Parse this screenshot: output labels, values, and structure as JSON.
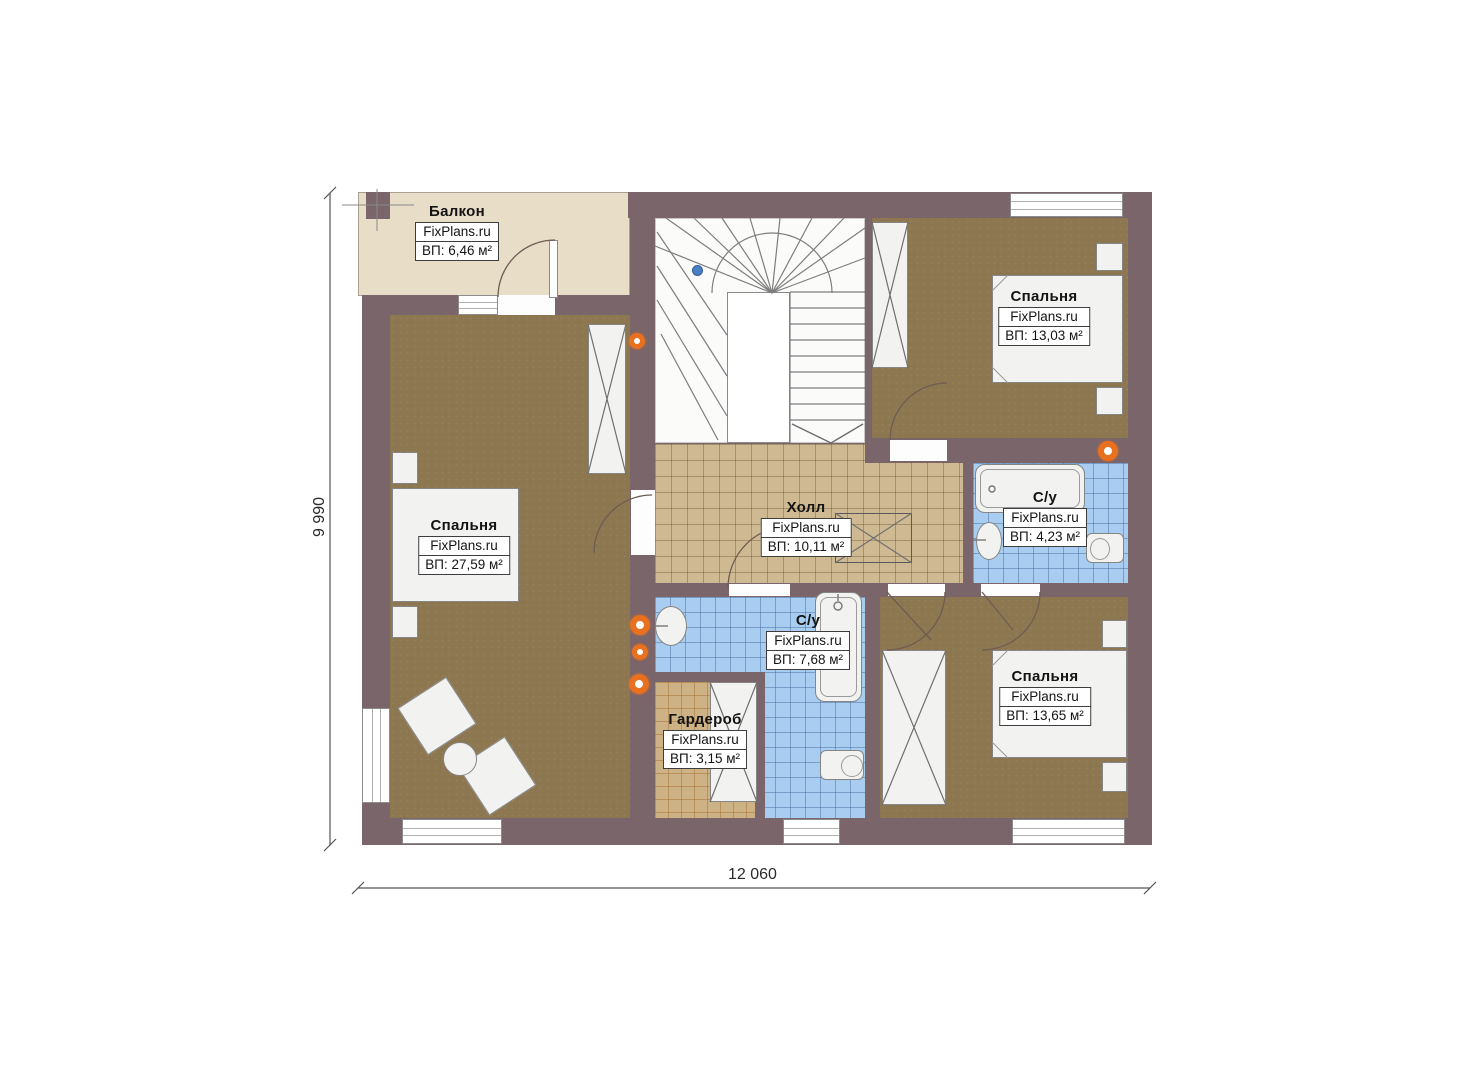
{
  "brand": "FixPlans.ru",
  "rooms": [
    {
      "id": "balcony",
      "name": "Балкон",
      "area": "ВП: 6,46 м²"
    },
    {
      "id": "bedroom-left",
      "name": "Спальня",
      "area": "ВП: 27,59 м²"
    },
    {
      "id": "bedroom-top-right",
      "name": "Спальня",
      "area": "ВП: 13,03 м²"
    },
    {
      "id": "hall",
      "name": "Холл",
      "area": "ВП: 10,11 м²"
    },
    {
      "id": "bathroom-right",
      "name": "С/у",
      "area": "ВП: 4,23 м²"
    },
    {
      "id": "bathroom-middle",
      "name": "С/у",
      "area": "ВП: 7,68 м²"
    },
    {
      "id": "wardrobe",
      "name": "Гардероб",
      "area": "ВП: 3,15 м²"
    },
    {
      "id": "bedroom-bottom-right",
      "name": "Спальня",
      "area": "ВП: 13,65 м²"
    }
  ],
  "dimensions": {
    "width": "12 060",
    "height": "9 990"
  },
  "colors": {
    "wall": "#7a656a",
    "bedroom_floor": "#8d7751",
    "hall_tile": "#cfb992",
    "bathroom_tile": "#a9cdf0",
    "wardrobe_tile": "#ccb284",
    "balcony_floor": "#e8ddc7",
    "radiator": "#e8701e",
    "stair_marker": "#4b7fc1"
  }
}
